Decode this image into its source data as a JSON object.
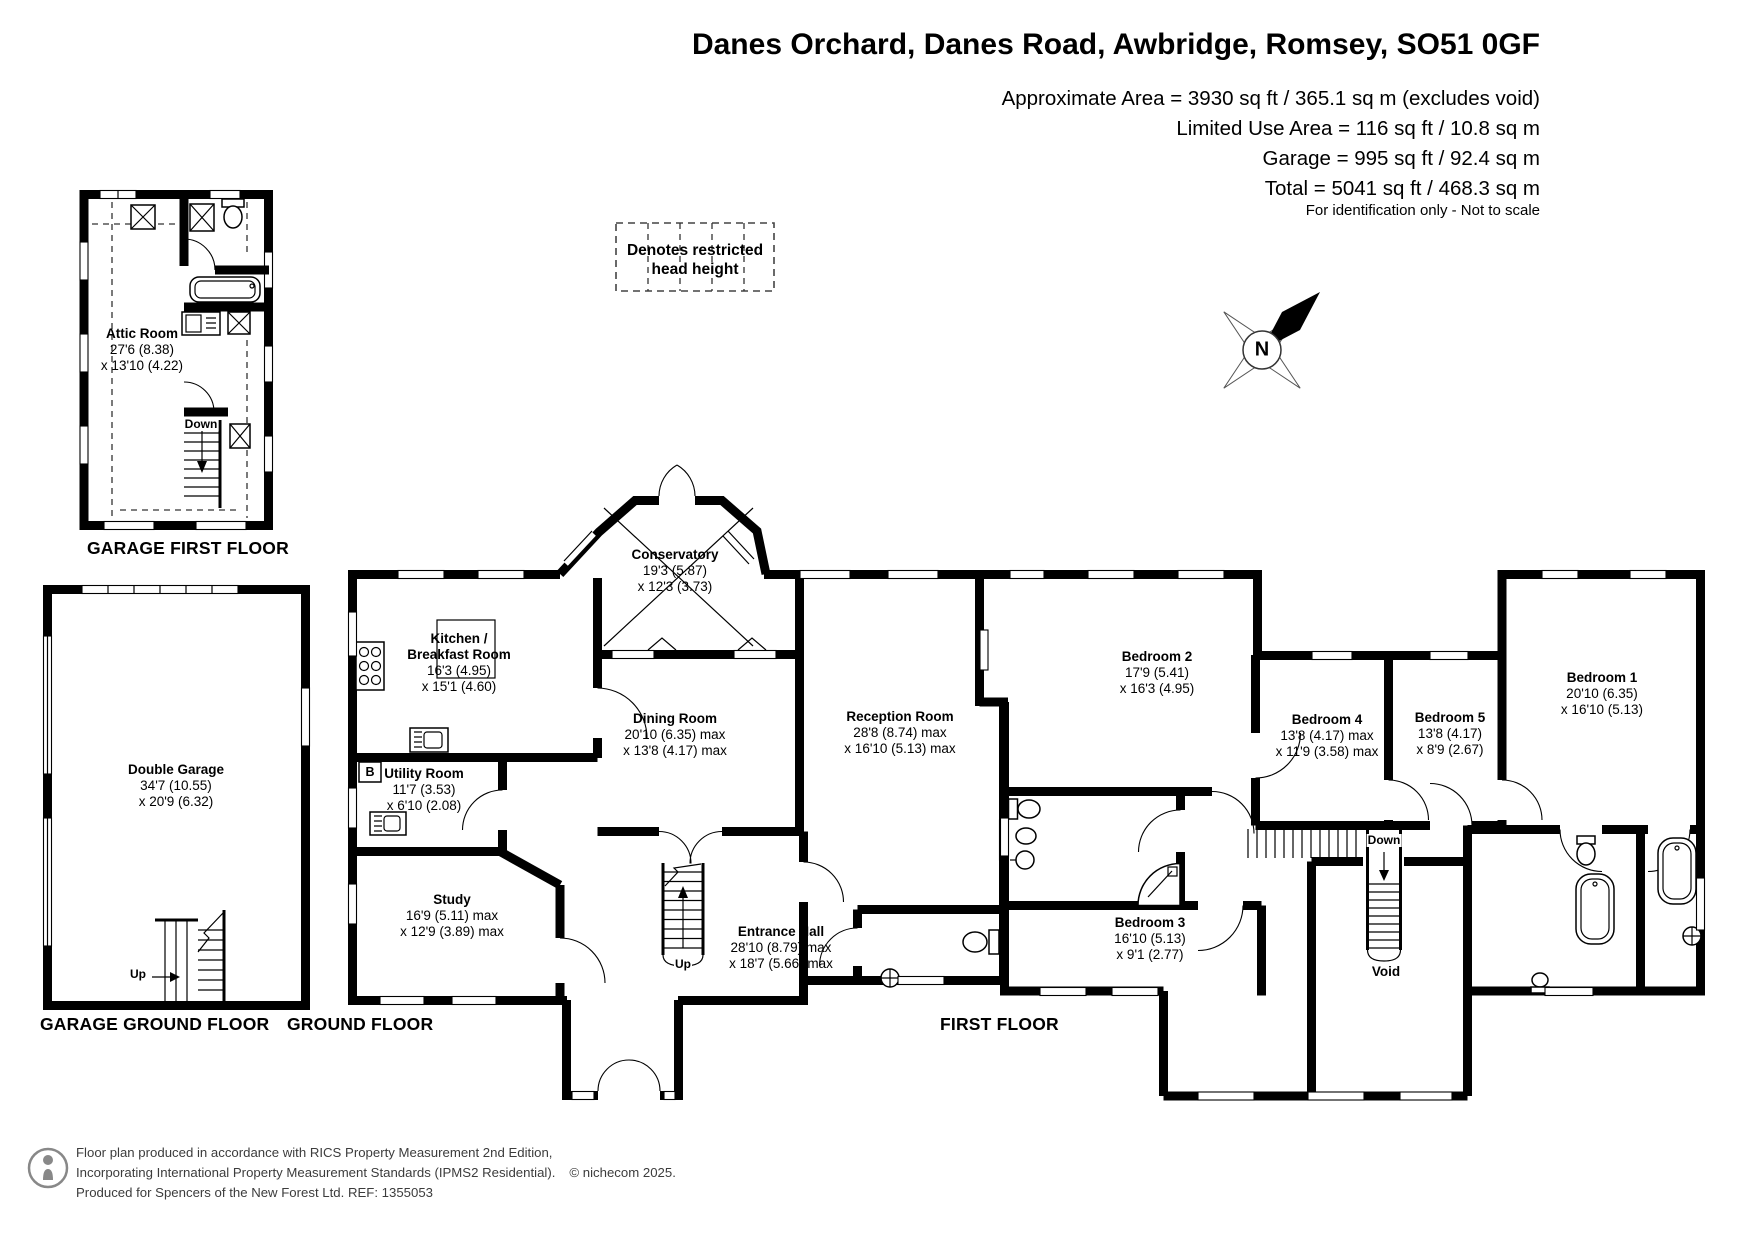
{
  "header": {
    "title": "Danes Orchard, Danes Road, Awbridge, Romsey, SO51 0GF",
    "area_lines": [
      "Approximate Area = 3930 sq ft / 365.1 sq m (excludes void)",
      "Limited Use Area = 116 sq ft / 10.8 sq m",
      "Garage = 995 sq ft / 92.4 sq m",
      "Total = 5041 sq ft / 468.3 sq m"
    ],
    "disclaimer": "For identification only - Not to scale"
  },
  "legend": {
    "line1": "Denotes restricted",
    "line2": "head height"
  },
  "compass": {
    "north": "N"
  },
  "floors": {
    "garage_first": {
      "caption": "GARAGE FIRST FLOOR",
      "attic": {
        "name": "Attic Room",
        "dim1": "27'6 (8.38)",
        "dim2": "x 13'10 (4.22)"
      },
      "stair": "Down"
    },
    "garage_ground": {
      "caption": "GARAGE GROUND FLOOR",
      "garage": {
        "name": "Double Garage",
        "dim1": "34'7 (10.55)",
        "dim2": "x 20'9 (6.32)"
      },
      "stair": "Up"
    },
    "ground": {
      "caption": "GROUND FLOOR",
      "conservatory": {
        "name": "Conservatory",
        "dim1": "19'3 (5.87)",
        "dim2": "x 12'3 (3.73)"
      },
      "kitchen": {
        "name": "Kitchen /",
        "name2": "Breakfast Room",
        "dim1": "16'3 (4.95)",
        "dim2": "x 15'1 (4.60)"
      },
      "dining": {
        "name": "Dining Room",
        "dim1": "20'10 (6.35) max",
        "dim2": "x 13'8 (4.17) max"
      },
      "reception": {
        "name": "Reception Room",
        "dim1": "28'8 (8.74) max",
        "dim2": "x 16'10 (5.13) max"
      },
      "utility": {
        "name": "Utility Room",
        "dim1": "11'7 (3.53)",
        "dim2": "x 6'10 (2.08)"
      },
      "study": {
        "name": "Study",
        "dim1": "16'9 (5.11) max",
        "dim2": "x 12'9 (3.89) max"
      },
      "hall": {
        "name": "Entrance Hall",
        "dim1": "28'10 (8.79) max",
        "dim2": "x 18'7 (5.66) max"
      },
      "boiler": "B",
      "stair": "Up"
    },
    "first": {
      "caption": "FIRST FLOOR",
      "bedroom1": {
        "name": "Bedroom 1",
        "dim1": "20'10 (6.35)",
        "dim2": "x 16'10 (5.13)"
      },
      "bedroom2": {
        "name": "Bedroom 2",
        "dim1": "17'9 (5.41)",
        "dim2": "x 16'3 (4.95)"
      },
      "bedroom3": {
        "name": "Bedroom 3",
        "dim1": "16'10 (5.13)",
        "dim2": "x 9'1 (2.77)"
      },
      "bedroom4": {
        "name": "Bedroom 4",
        "dim1": "13'8 (4.17) max",
        "dim2": "x 11'9 (3.58) max"
      },
      "bedroom5": {
        "name": "Bedroom 5",
        "dim1": "13'8 (4.17)",
        "dim2": "x 8'9 (2.67)"
      },
      "void_label": "Void",
      "stair": "Down"
    }
  },
  "footer": {
    "line1": "Floor plan produced in accordance with RICS Property Measurement 2nd Edition,",
    "line2": "Incorporating International Property Measurement Standards (IPMS2 Residential).",
    "copyright": "© nichecom 2025.",
    "line3": "Produced for Spencers of the New Forest Ltd.   REF: 1355053"
  },
  "colors": {
    "wall": "#000000",
    "background": "#ffffff",
    "footer_text": "#3c3c3c"
  }
}
